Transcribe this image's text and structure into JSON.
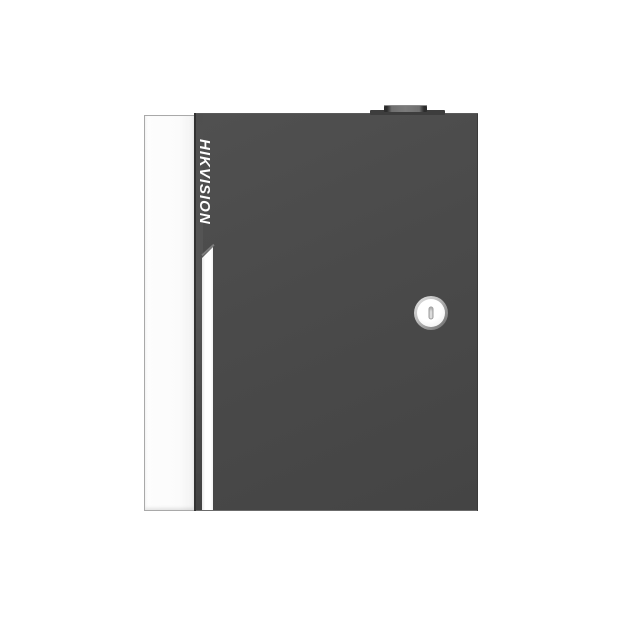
{
  "scene": {
    "background_color": "#ffffff",
    "subject": "wall-mount security controller cabinet, front view"
  },
  "device": {
    "brand": "HIKVISION",
    "body_color": "#4a4a4a",
    "side_panel_color": "#ffffff",
    "accent_stripe_color": "#ffffff",
    "logo_color": "#ffffff",
    "logo_orientation": "vertical-rotated-90deg",
    "hinge_gap_color": "#323232",
    "knob_color": "#3d3d3d",
    "lock_ring_color": "#8a8a8a",
    "lock_face_color": "#ffffff",
    "icons": [
      "cam-lock-icon",
      "hinge-knob-icon"
    ]
  }
}
